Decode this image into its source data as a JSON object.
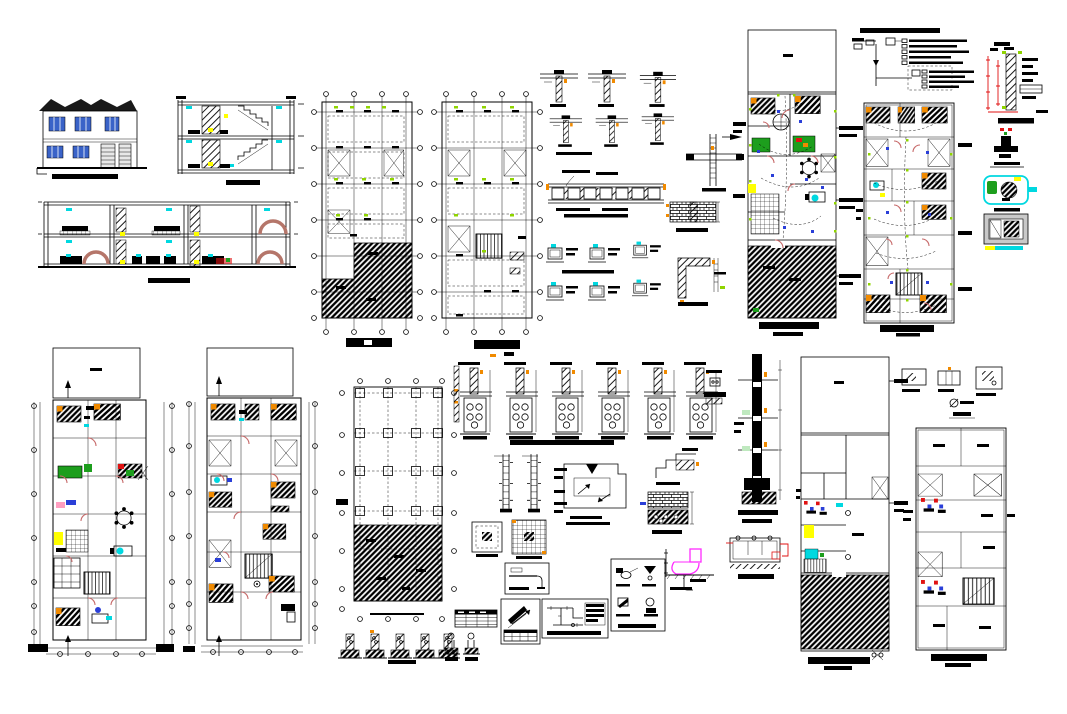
{
  "sheet": {
    "width_px": 1067,
    "height_px": 714,
    "background": "#ffffff",
    "kind": "architectural-cad-working-drawing-sheet",
    "visible_text": "none-legible (all drawing titles and dimension text render as solid marks at this resolution)"
  },
  "colors": {
    "ink": "#000000",
    "paper": "#ffffff",
    "window": "#3a63c8",
    "cyan": "#00d8e0",
    "yellow": "#ffff00",
    "green": "#1d9e1d",
    "lime": "#8fd400",
    "orange": "#f08a00",
    "red": "#e01212",
    "rose": "#c76a6a",
    "magenta": "#ff2bff",
    "blue": "#2a3fd8",
    "brick": "#b5766a",
    "gray": "#c9c9c9",
    "mint": "#bfe9bf",
    "pink": "#ff9ec0"
  },
  "panels": [
    {
      "name": "front-elevation",
      "kind": "elevation"
    },
    {
      "name": "stair-cross-section",
      "kind": "section"
    },
    {
      "name": "longitudinal-section",
      "kind": "section"
    },
    {
      "name": "slab-framing-plan-1",
      "kind": "structural-plan"
    },
    {
      "name": "slab-framing-plan-2",
      "kind": "structural-plan"
    },
    {
      "name": "beam-column-connection-details",
      "kind": "detail-group"
    },
    {
      "name": "column-splice-detail",
      "kind": "detail"
    },
    {
      "name": "joist-slab-section-detail",
      "kind": "detail"
    },
    {
      "name": "masonry-wall-detail",
      "kind": "detail"
    },
    {
      "name": "stirrup-beam-details",
      "kind": "detail-group"
    },
    {
      "name": "corner-column-plan-detail",
      "kind": "detail"
    },
    {
      "name": "electrical-riser-diagram",
      "kind": "schematic"
    },
    {
      "name": "parapet-wall-section-detail",
      "kind": "detail"
    },
    {
      "name": "valve-assembly-detail",
      "kind": "detail"
    },
    {
      "name": "water-meter-plan-detail",
      "kind": "detail"
    },
    {
      "name": "panel-niche-detail",
      "kind": "detail"
    },
    {
      "name": "ground-floor-electrical-plan",
      "kind": "floor-plan"
    },
    {
      "name": "upper-floor-electrical-plan",
      "kind": "floor-plan"
    },
    {
      "name": "ground-floor-furnished-plan",
      "kind": "floor-plan"
    },
    {
      "name": "upper-floor-furnished-plan",
      "kind": "floor-plan"
    },
    {
      "name": "foundation-plan",
      "kind": "structural-plan"
    },
    {
      "name": "column-base-details-row",
      "kind": "detail-group"
    },
    {
      "name": "footing-reinforcement-details",
      "kind": "detail-group"
    },
    {
      "name": "column-elevation-details",
      "kind": "detail-group"
    },
    {
      "name": "roof-drainage-diagram",
      "kind": "diagram"
    },
    {
      "name": "parapet-step-detail",
      "kind": "detail"
    },
    {
      "name": "brick-footing-detail",
      "kind": "detail"
    },
    {
      "name": "footing-plan-details",
      "kind": "detail-group"
    },
    {
      "name": "pipe-elbow-framed-detail",
      "kind": "detail"
    },
    {
      "name": "rebar-schedule-table",
      "kind": "table"
    },
    {
      "name": "small-column-section-details",
      "kind": "detail-group"
    },
    {
      "name": "north-arrow-and-table-box",
      "kind": "detail"
    },
    {
      "name": "water-piping-diagram-box",
      "kind": "schematic"
    },
    {
      "name": "sanitary-fixture-details-box",
      "kind": "detail-group"
    },
    {
      "name": "toilet-section-detail",
      "kind": "detail"
    },
    {
      "name": "chimney-wall-section",
      "kind": "section"
    },
    {
      "name": "septic-tank-section-detail",
      "kind": "detail"
    },
    {
      "name": "ground-floor-plumbing-plan",
      "kind": "floor-plan"
    },
    {
      "name": "upper-floor-plumbing-plan",
      "kind": "floor-plan"
    },
    {
      "name": "misc-beam-details-top-right",
      "kind": "detail-group"
    }
  ]
}
